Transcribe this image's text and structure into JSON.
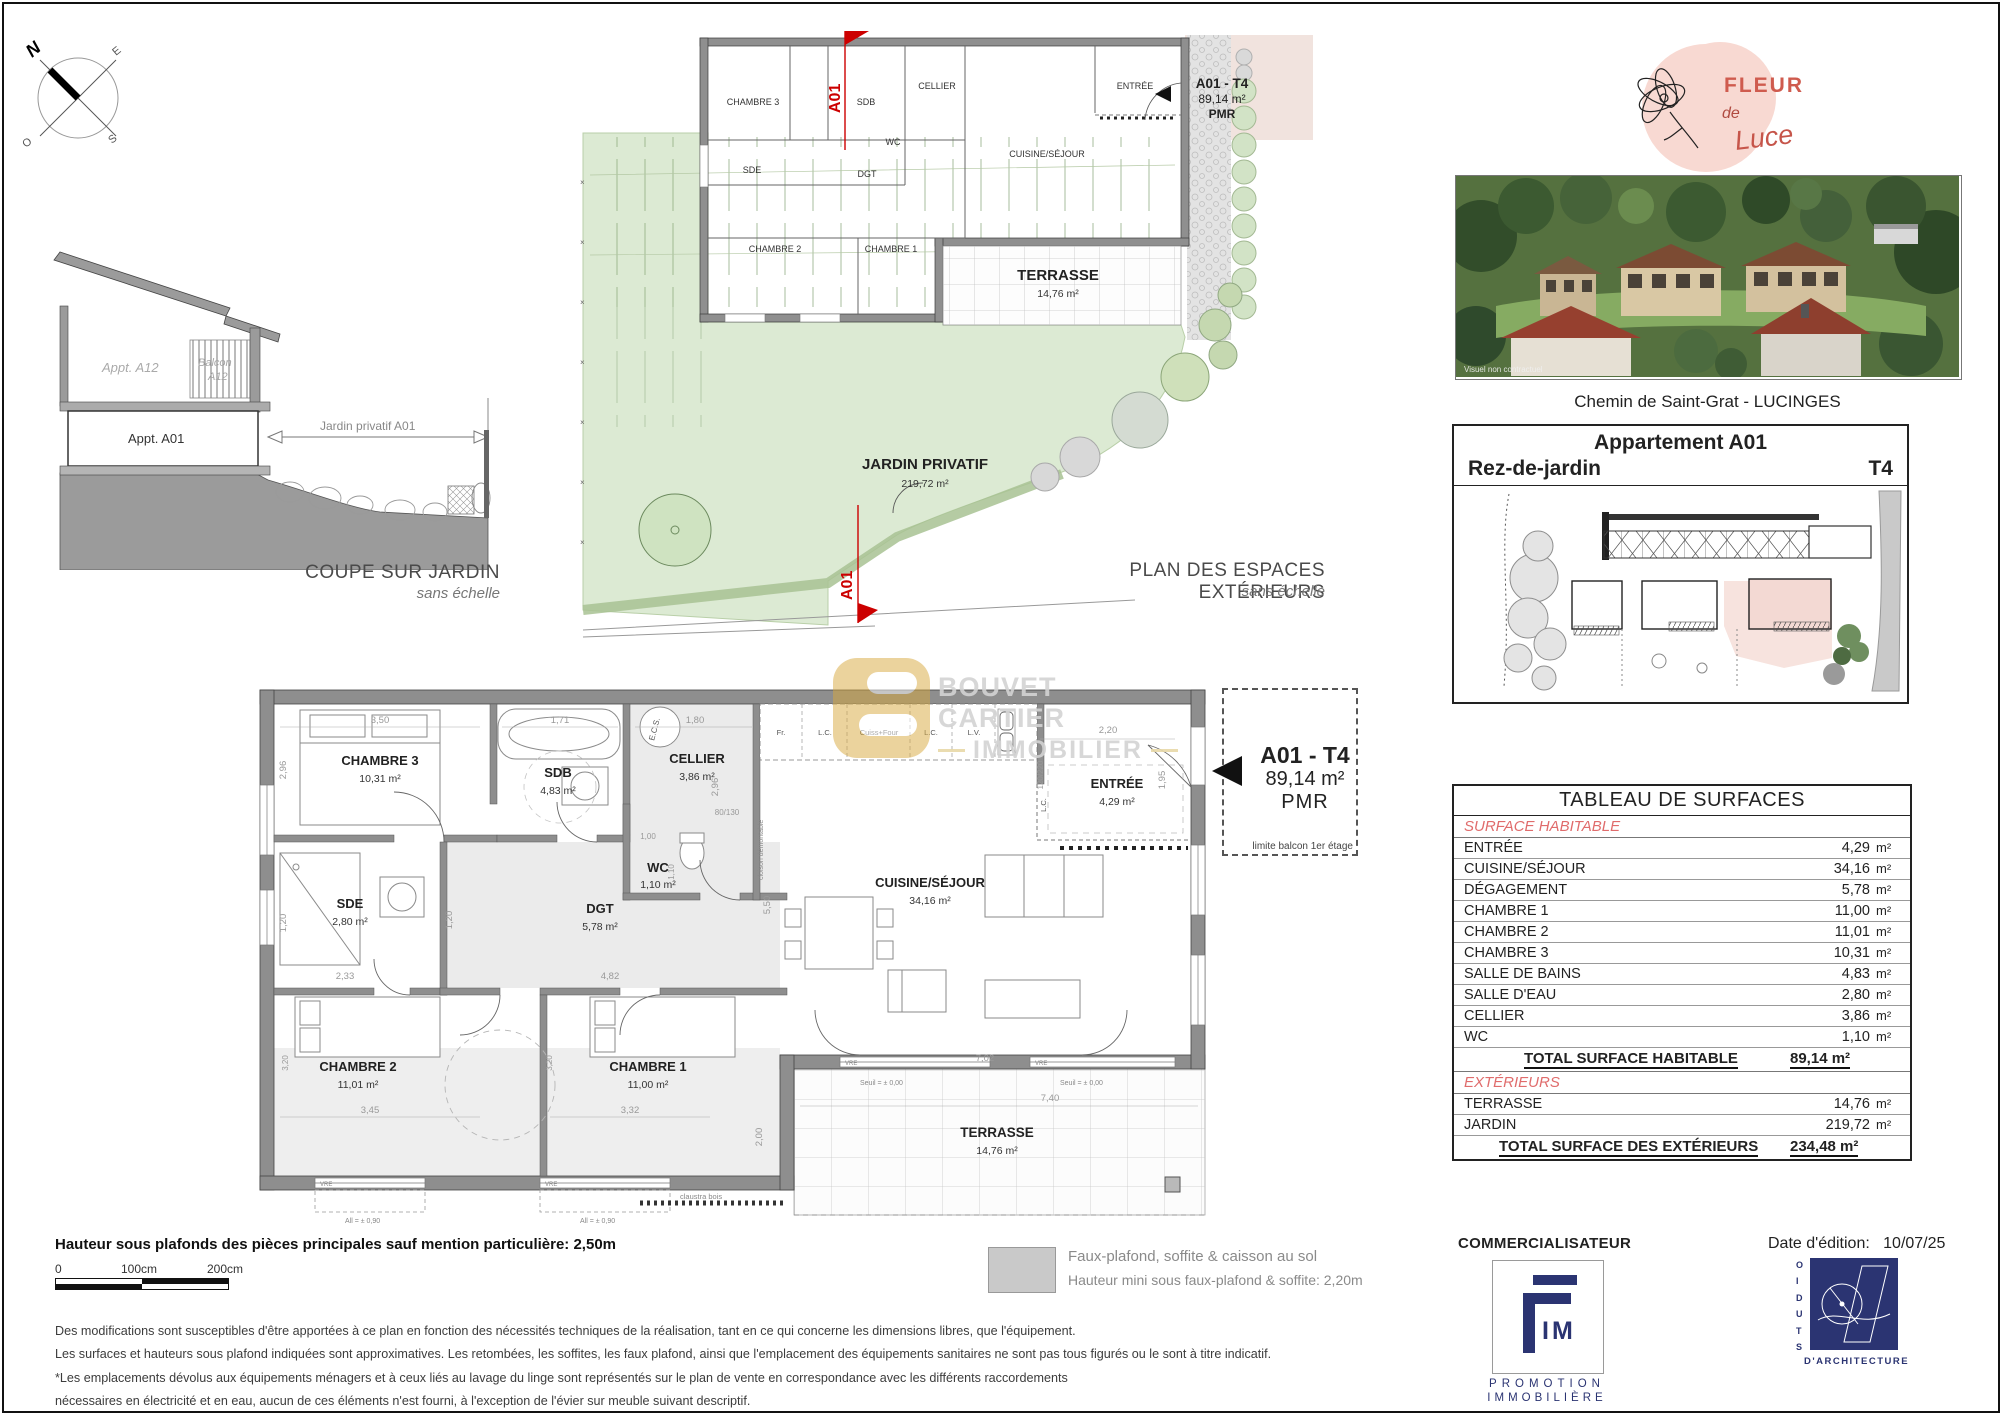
{
  "compass": {
    "n": "N",
    "e": "E",
    "s": "S",
    "o": "O"
  },
  "coupe": {
    "appt_a12": "Appt. A12",
    "balcon_line1": "Balcon",
    "balcon_line2": "A12",
    "appt_a01": "Appt. A01",
    "jardin_dim": "Jardin privatif A01",
    "title": "COUPE SUR JARDIN",
    "subtitle": "sans échelle"
  },
  "ext_plan": {
    "rooms": {
      "chambre3": "CHAMBRE 3",
      "sdb": "SDB",
      "cellier": "CELLIER",
      "entree": "ENTRÉE",
      "wc": "WC",
      "sde": "SDE",
      "dgt": "DGT",
      "cuisine": "CUISINE/SÉJOUR",
      "chambre2": "CHAMBRE 2",
      "chambre1": "CHAMBRE 1",
      "terrasse": "TERRASSE",
      "terrasse_area": "14,76 m²"
    },
    "jardin_label": "JARDIN PRIVATIF",
    "jardin_area": "219,72 m²",
    "section_marker": "A01",
    "unit_line1": "A01 - T4",
    "unit_line2": "89,14 m²",
    "unit_line3": "PMR",
    "title": "PLAN DES ESPACES EXTÉRIEURS",
    "subtitle": "sans échelle"
  },
  "main_plan": {
    "rooms": {
      "chambre3": {
        "name": "CHAMBRE 3",
        "area": "10,31 m²"
      },
      "sdb": {
        "name": "SDB",
        "area": "4,83 m²"
      },
      "cellier": {
        "name": "CELLIER",
        "area": "3,86 m²"
      },
      "wc": {
        "name": "WC",
        "area": "1,10 m²"
      },
      "sde": {
        "name": "SDE",
        "area": "2,80 m²"
      },
      "dgt": {
        "name": "DGT",
        "area": "5,78 m²"
      },
      "entree": {
        "name": "ENTRÉE",
        "area": "4,29 m²"
      },
      "cuisine": {
        "name": "CUISINE/SÉJOUR",
        "area": "34,16 m²"
      },
      "chambre2": {
        "name": "CHAMBRE 2",
        "area": "11,01 m²"
      },
      "chambre1": {
        "name": "CHAMBRE 1",
        "area": "11,00 m²"
      },
      "terrasse": {
        "name": "TERRASSE",
        "area": "14,76 m²"
      }
    },
    "dims": {
      "chambre3_w": "3,50",
      "chambre3_h": "2,96",
      "sdb_w": "1,71",
      "cellier_w": "1,80",
      "cellier_h": "2,96",
      "wc_w": "1,00",
      "wc_h": "1,10",
      "sde_w": "2,33",
      "sde_h": "1,20",
      "dgt_w": "4,82",
      "dgt_h": "1,20",
      "cuisine_w": "7,02",
      "cuisine_h": "5,50",
      "entree_w": "2,20",
      "entree_h": "1,95",
      "chambre2_w": "3,45",
      "chambre2_h": "3,20",
      "chambre1_w": "3,32",
      "chambre1_h": "3,20",
      "terrasse_w": "7,40",
      "terrasse_h": "2,00",
      "door": "120/220",
      "window": "80/130"
    },
    "kitchen": {
      "fr": "Fr.",
      "lc1": "L.C.",
      "four": "Cuiss+Four",
      "lc2": "L.C.",
      "lv": "L.V.",
      "lc3": "L.C.",
      "ecs": "E.C.S."
    },
    "notes": {
      "cloison": "cloison démontable",
      "seuil": "Seuil = ± 0,00",
      "allege": "All = ± 0,90",
      "vre": "VRE",
      "claustra": "claustra bois",
      "limite": "limite balcon 1er étage"
    },
    "unit_line1": "A01 - T4",
    "unit_line2": "89,14 m²",
    "unit_line3": "PMR"
  },
  "watermark": {
    "line1": "BOUVET CARTIER",
    "line2": "IMMOBILIER"
  },
  "sidebar": {
    "logo": {
      "word1": "FLEUR",
      "word2": "de",
      "word3": "Luce"
    },
    "photo_caption": "Visuel non contractuel",
    "address": "Chemin de Saint-Grat - LUCINGES",
    "unit_box": {
      "title": "Appartement A01",
      "floor": "Rez-de-jardin",
      "type": "T4"
    },
    "table": {
      "title": "TABLEAU DE SURFACES",
      "unit": "m²",
      "section1": "SURFACE HABITABLE",
      "rows": [
        {
          "label": "ENTRÉE",
          "value": "4,29"
        },
        {
          "label": "CUISINE/SÉJOUR",
          "value": "34,16"
        },
        {
          "label": "DÉGAGEMENT",
          "value": "5,78"
        },
        {
          "label": "CHAMBRE 1",
          "value": "11,00"
        },
        {
          "label": "CHAMBRE 2",
          "value": "11,01"
        },
        {
          "label": "CHAMBRE 3",
          "value": "10,31"
        },
        {
          "label": "SALLE DE BAINS",
          "value": "4,83"
        },
        {
          "label": "SALLE D'EAU",
          "value": "2,80"
        },
        {
          "label": "CELLIER",
          "value": "3,86"
        },
        {
          "label": "WC",
          "value": "1,10"
        }
      ],
      "total1_label": "TOTAL SURFACE HABITABLE",
      "total1_value": "89,14 m²",
      "section2": "EXTÉRIEURS",
      "ext_rows": [
        {
          "label": "TERRASSE",
          "value": "14,76"
        },
        {
          "label": "JARDIN",
          "value": "219,72"
        }
      ],
      "total2_label": "TOTAL SURFACE DES EXTÉRIEURS",
      "total2_value": "234,48 m²"
    }
  },
  "footer": {
    "height_note": "Hauteur sous plafonds des pièces principales sauf mention particulière: 2,50m",
    "scale": {
      "t0": "0",
      "t1": "100cm",
      "t2": "200cm"
    },
    "legend_line1": "Faux-plafond, soffite & caisson au sol",
    "legend_line2": "Hauteur mini sous faux-plafond & soffite: 2,20m",
    "disclaimer1": "Des modifications sont susceptibles d'être apportées à ce plan en fonction des nécessités techniques de la réalisation, tant en ce qui concerne les dimensions libres, que l'équipement.",
    "disclaimer2": "Les surfaces et hauteurs sous plafond indiquées sont approximatives. Les retombées, les soffites, les faux plafond, ainsi que l'emplacement des équipements sanitaires ne sont pas tous figurés ou le sont à titre indicatif.",
    "disclaimer3": "*Les emplacements dévolus aux équipements ménagers et à ceux liés au lavage du linge sont représentés sur le plan de vente en correspondance avec les différents raccordements",
    "disclaimer4": "nécessaires en électricité et en eau, aucun de ces éléments n'est fourni, à l'exception de l'évier sur meuble suivant descriptif.",
    "commercialisateur": "COMMERCIALISATEUR",
    "fim": {
      "im": "IM",
      "sub1": "PROMOTION",
      "sub2": "IMMOBILIÈRE"
    },
    "date_label": "Date d'édition:",
    "date_value": "10/07/25",
    "studio": {
      "vertical": "STUDIO",
      "sub": "D'ARCHITECTURE"
    }
  }
}
